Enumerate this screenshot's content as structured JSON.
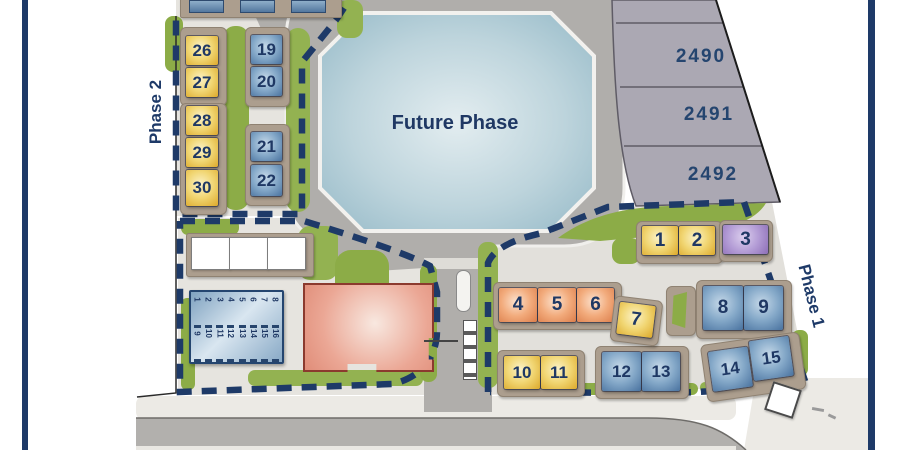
{
  "site": {
    "future_phase_label": "Future Phase",
    "phase1_label": "Phase 1",
    "phase2_label": "Phase 2"
  },
  "parcels": {
    "labels": [
      "2490",
      "2491",
      "2492"
    ]
  },
  "phase2": {
    "yellow_lots": [
      "26",
      "27",
      "28",
      "29",
      "30"
    ],
    "blue_lots": [
      "19",
      "20",
      "21",
      "22"
    ]
  },
  "phase1": {
    "lots": [
      {
        "num": "1",
        "color": "yellow"
      },
      {
        "num": "2",
        "color": "yellow"
      },
      {
        "num": "3",
        "color": "purple"
      },
      {
        "num": "4",
        "color": "orange"
      },
      {
        "num": "5",
        "color": "orange"
      },
      {
        "num": "6",
        "color": "orange"
      },
      {
        "num": "7",
        "color": "yellow"
      },
      {
        "num": "8",
        "color": "blue"
      },
      {
        "num": "9",
        "color": "blue"
      },
      {
        "num": "10",
        "color": "yellow"
      },
      {
        "num": "11",
        "color": "yellow"
      },
      {
        "num": "12",
        "color": "blue"
      },
      {
        "num": "13",
        "color": "blue"
      },
      {
        "num": "14",
        "color": "blue"
      },
      {
        "num": "15",
        "color": "blue"
      }
    ]
  },
  "garage_building": {
    "row1": [
      "1",
      "2",
      "3",
      "4",
      "5",
      "6",
      "7",
      "8"
    ],
    "row2": [
      "9",
      "10",
      "11",
      "12",
      "13",
      "14",
      "15",
      "16"
    ]
  },
  "colors": {
    "navy": "#1E3A68",
    "lot_yellow": "#F1D673",
    "lot_blue": "#84A8C8",
    "lot_orange": "#F2AB7C",
    "lot_purple": "#B49DD6",
    "green": "#8CAC47",
    "pond": "#A9C7D3",
    "road": "#B2B0AD",
    "parcel_gray": "#ABA8B3",
    "clubhouse_red": "#E08D79"
  }
}
